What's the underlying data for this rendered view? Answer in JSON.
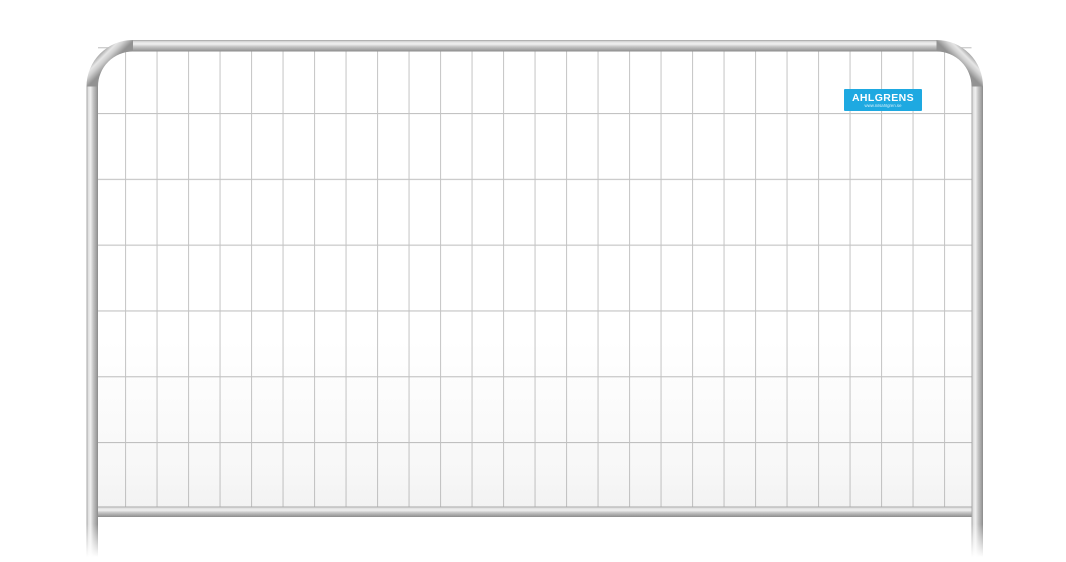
{
  "scene": {
    "type": "product-photo",
    "subject": "Galvanized steel temporary construction fence panel with rounded top corners, welded wire mesh, bottom rail and legs, on a plain white background",
    "background_color": "#ffffff"
  },
  "fence": {
    "frame_color_base": "#b5b5b5",
    "frame_highlight_color": "#f0f0f0",
    "frame_shadow_color": "#8a8a8a",
    "mesh_wire_color": "#c9c9c9",
    "mesh_columns": 28,
    "mesh_rows": 7
  },
  "brand_label": {
    "name": "AHLGRENS",
    "url": "www.nilsahlgren.se",
    "background_color": "#1ea9e1",
    "text_color": "#ffffff"
  }
}
